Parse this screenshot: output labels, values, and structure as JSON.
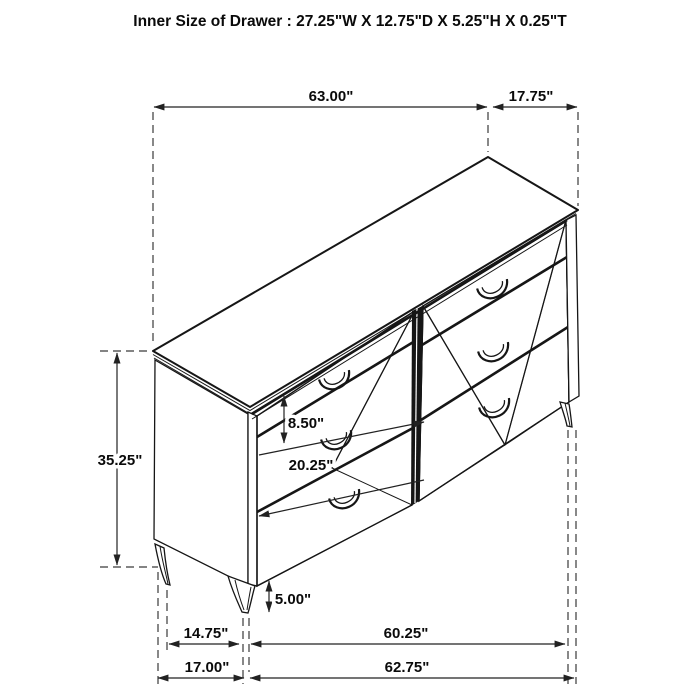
{
  "title": "Inner Size of Drawer : 27.25\"W X 12.75\"D X 5.25\"H X 0.25\"T",
  "dimensions": {
    "top_width": "63.00\"",
    "top_depth": "17.75\"",
    "body_height": "35.25\"",
    "top_drawer_front": "8.50\"",
    "lower_front_diagonal": "20.25\"",
    "leg_height": "5.00\"",
    "feet_inset_depth": "14.75\"",
    "feet_span_width": "60.25\"",
    "base_depth": "17.00\"",
    "base_width": "62.75\""
  },
  "colors": {
    "line": "#161616",
    "background": "#ffffff"
  }
}
